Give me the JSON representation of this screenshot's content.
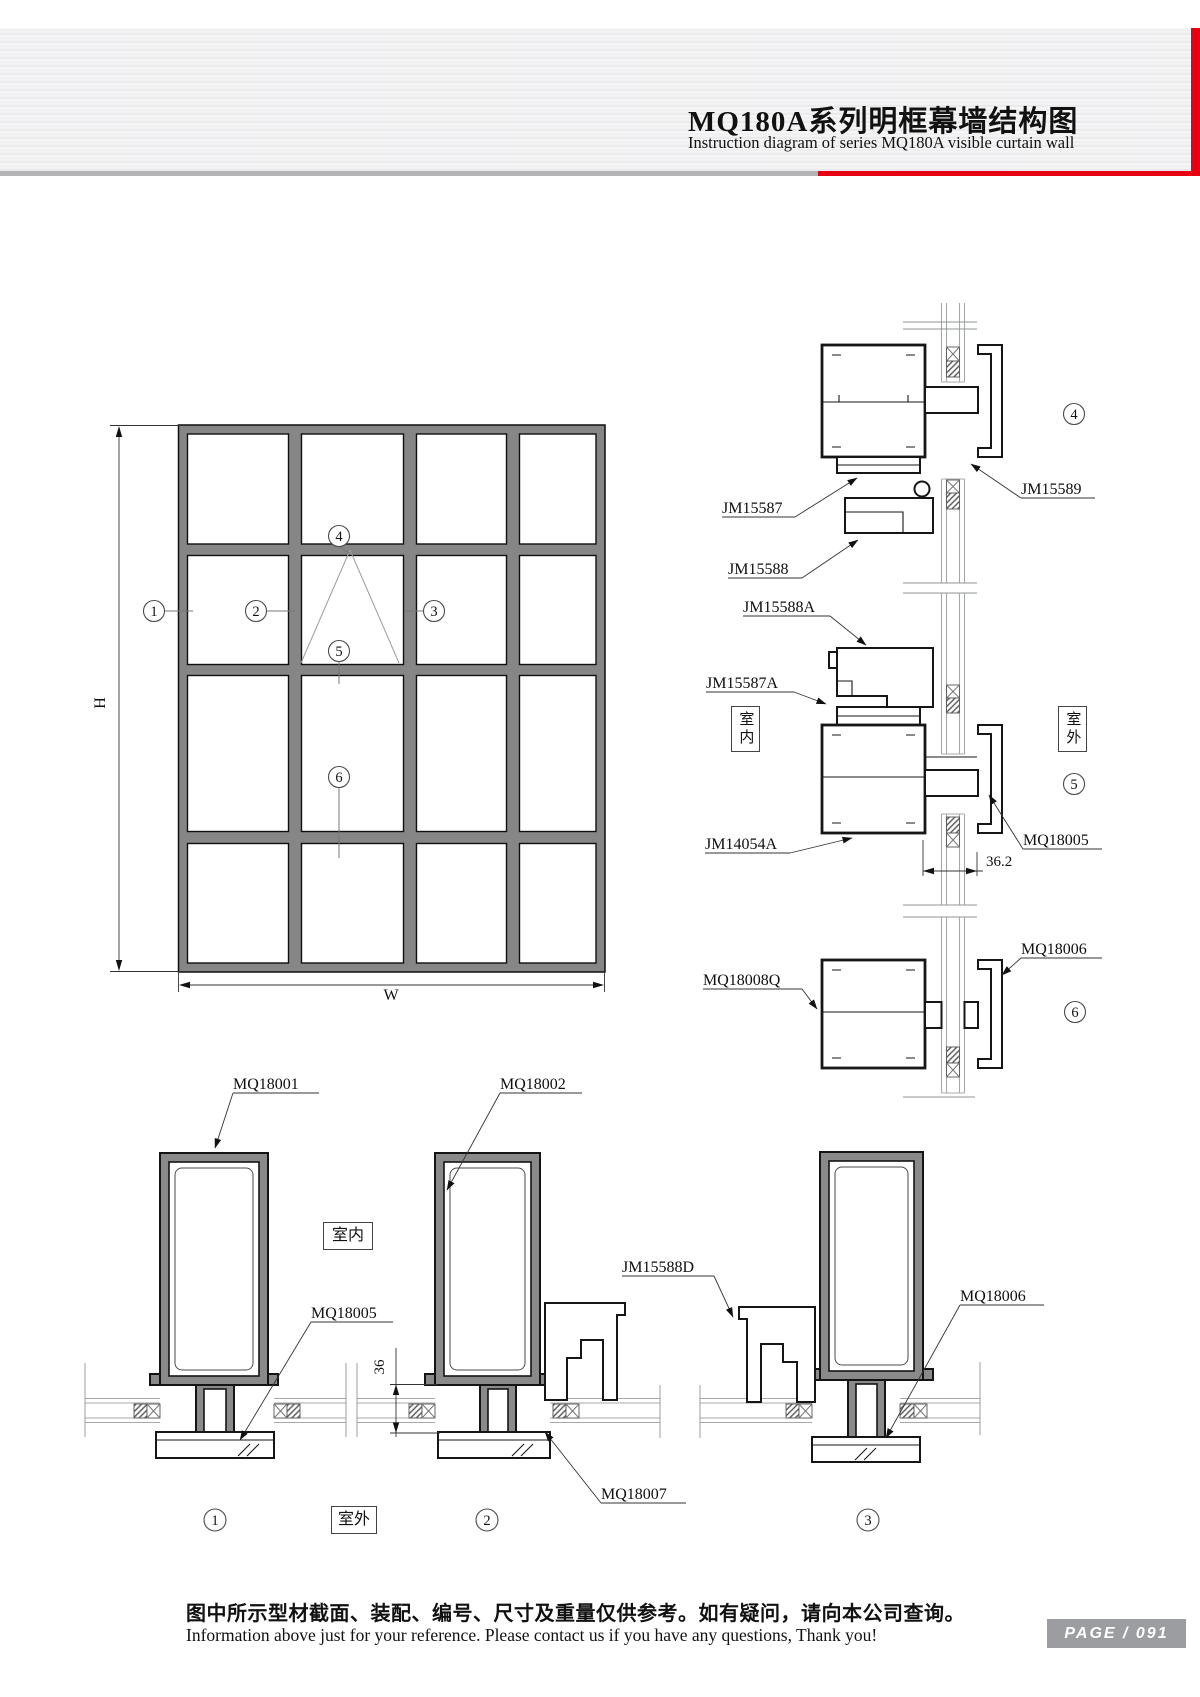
{
  "header": {
    "title_zh": "MQ180A系列明框幕墙结构图",
    "title_en": "Instruction diagram of series MQ180A visible curtain wall"
  },
  "colors": {
    "accent_red": "#e60012",
    "divider_gray": "#b4b4b6",
    "badge_gray": "#9b9da0"
  },
  "dims": {
    "h": "H",
    "w": "W",
    "d36_2": "36.2",
    "d36": "36"
  },
  "callouts": {
    "c1": "1",
    "c2": "2",
    "c3": "3",
    "c4": "4",
    "c5": "5",
    "c6": "6"
  },
  "zones": {
    "indoor": "室内",
    "outdoor": "室外"
  },
  "labels": {
    "jm15587": "JM15587",
    "jm15588": "JM15588",
    "jm15589": "JM15589",
    "jm15588a": "JM15588A",
    "jm15587a": "JM15587A",
    "jm14054a": "JM14054A",
    "mq18005_right": "MQ18005",
    "mq18008q": "MQ18008Q",
    "mq18006_right": "MQ18006",
    "mq18001": "MQ18001",
    "mq18002": "MQ18002",
    "mq18005_bottom": "MQ18005",
    "jm15588d": "JM15588D",
    "mq18006_bottom": "MQ18006",
    "mq18007": "MQ18007"
  },
  "footer": {
    "note_zh": "图中所示型材截面、装配、编号、尺寸及重量仅供参考。如有疑问，请向本公司查询。",
    "note_en": "Information above just for your reference. Please contact us if you have any questions, Thank you!",
    "page_badge": "PAGE / 091"
  }
}
